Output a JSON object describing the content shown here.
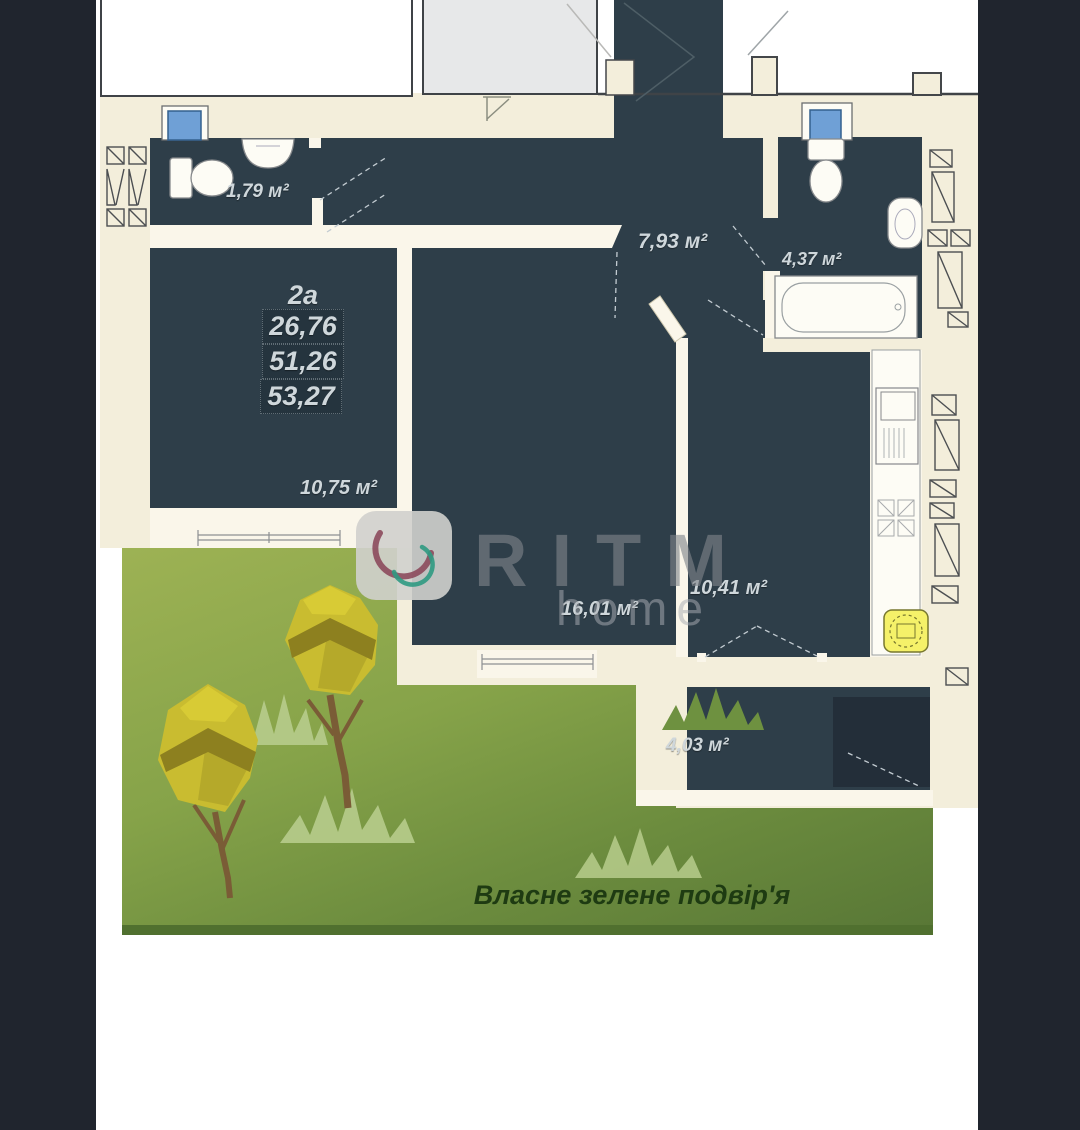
{
  "apartment": {
    "unit_label": "2а",
    "metrics": [
      "26,76",
      "51,26",
      "53,27"
    ]
  },
  "rooms": {
    "wc_small": "1,79 м²",
    "hall": "7,93 м²",
    "bathroom": "4,37 м²",
    "living": "10,75 м²",
    "bedroom": "16,01 м²",
    "kitchen": "10,41 м²",
    "balcony": "4,03 м²"
  },
  "yard": {
    "caption": "Власне зелене подвір'я"
  },
  "watermark": {
    "brand": "RITM",
    "suffix": "home"
  },
  "colors": {
    "floor_dark": "#2e3e49",
    "wall_beige": "#f3eedb",
    "window_blue": "#6fa0d6",
    "boiler_yellow": "#f5f169",
    "yard_green_top": "#9db254",
    "yard_green_bottom": "#587736",
    "logo_maroon": "#8c4a5c",
    "logo_teal": "#2f9a82"
  }
}
